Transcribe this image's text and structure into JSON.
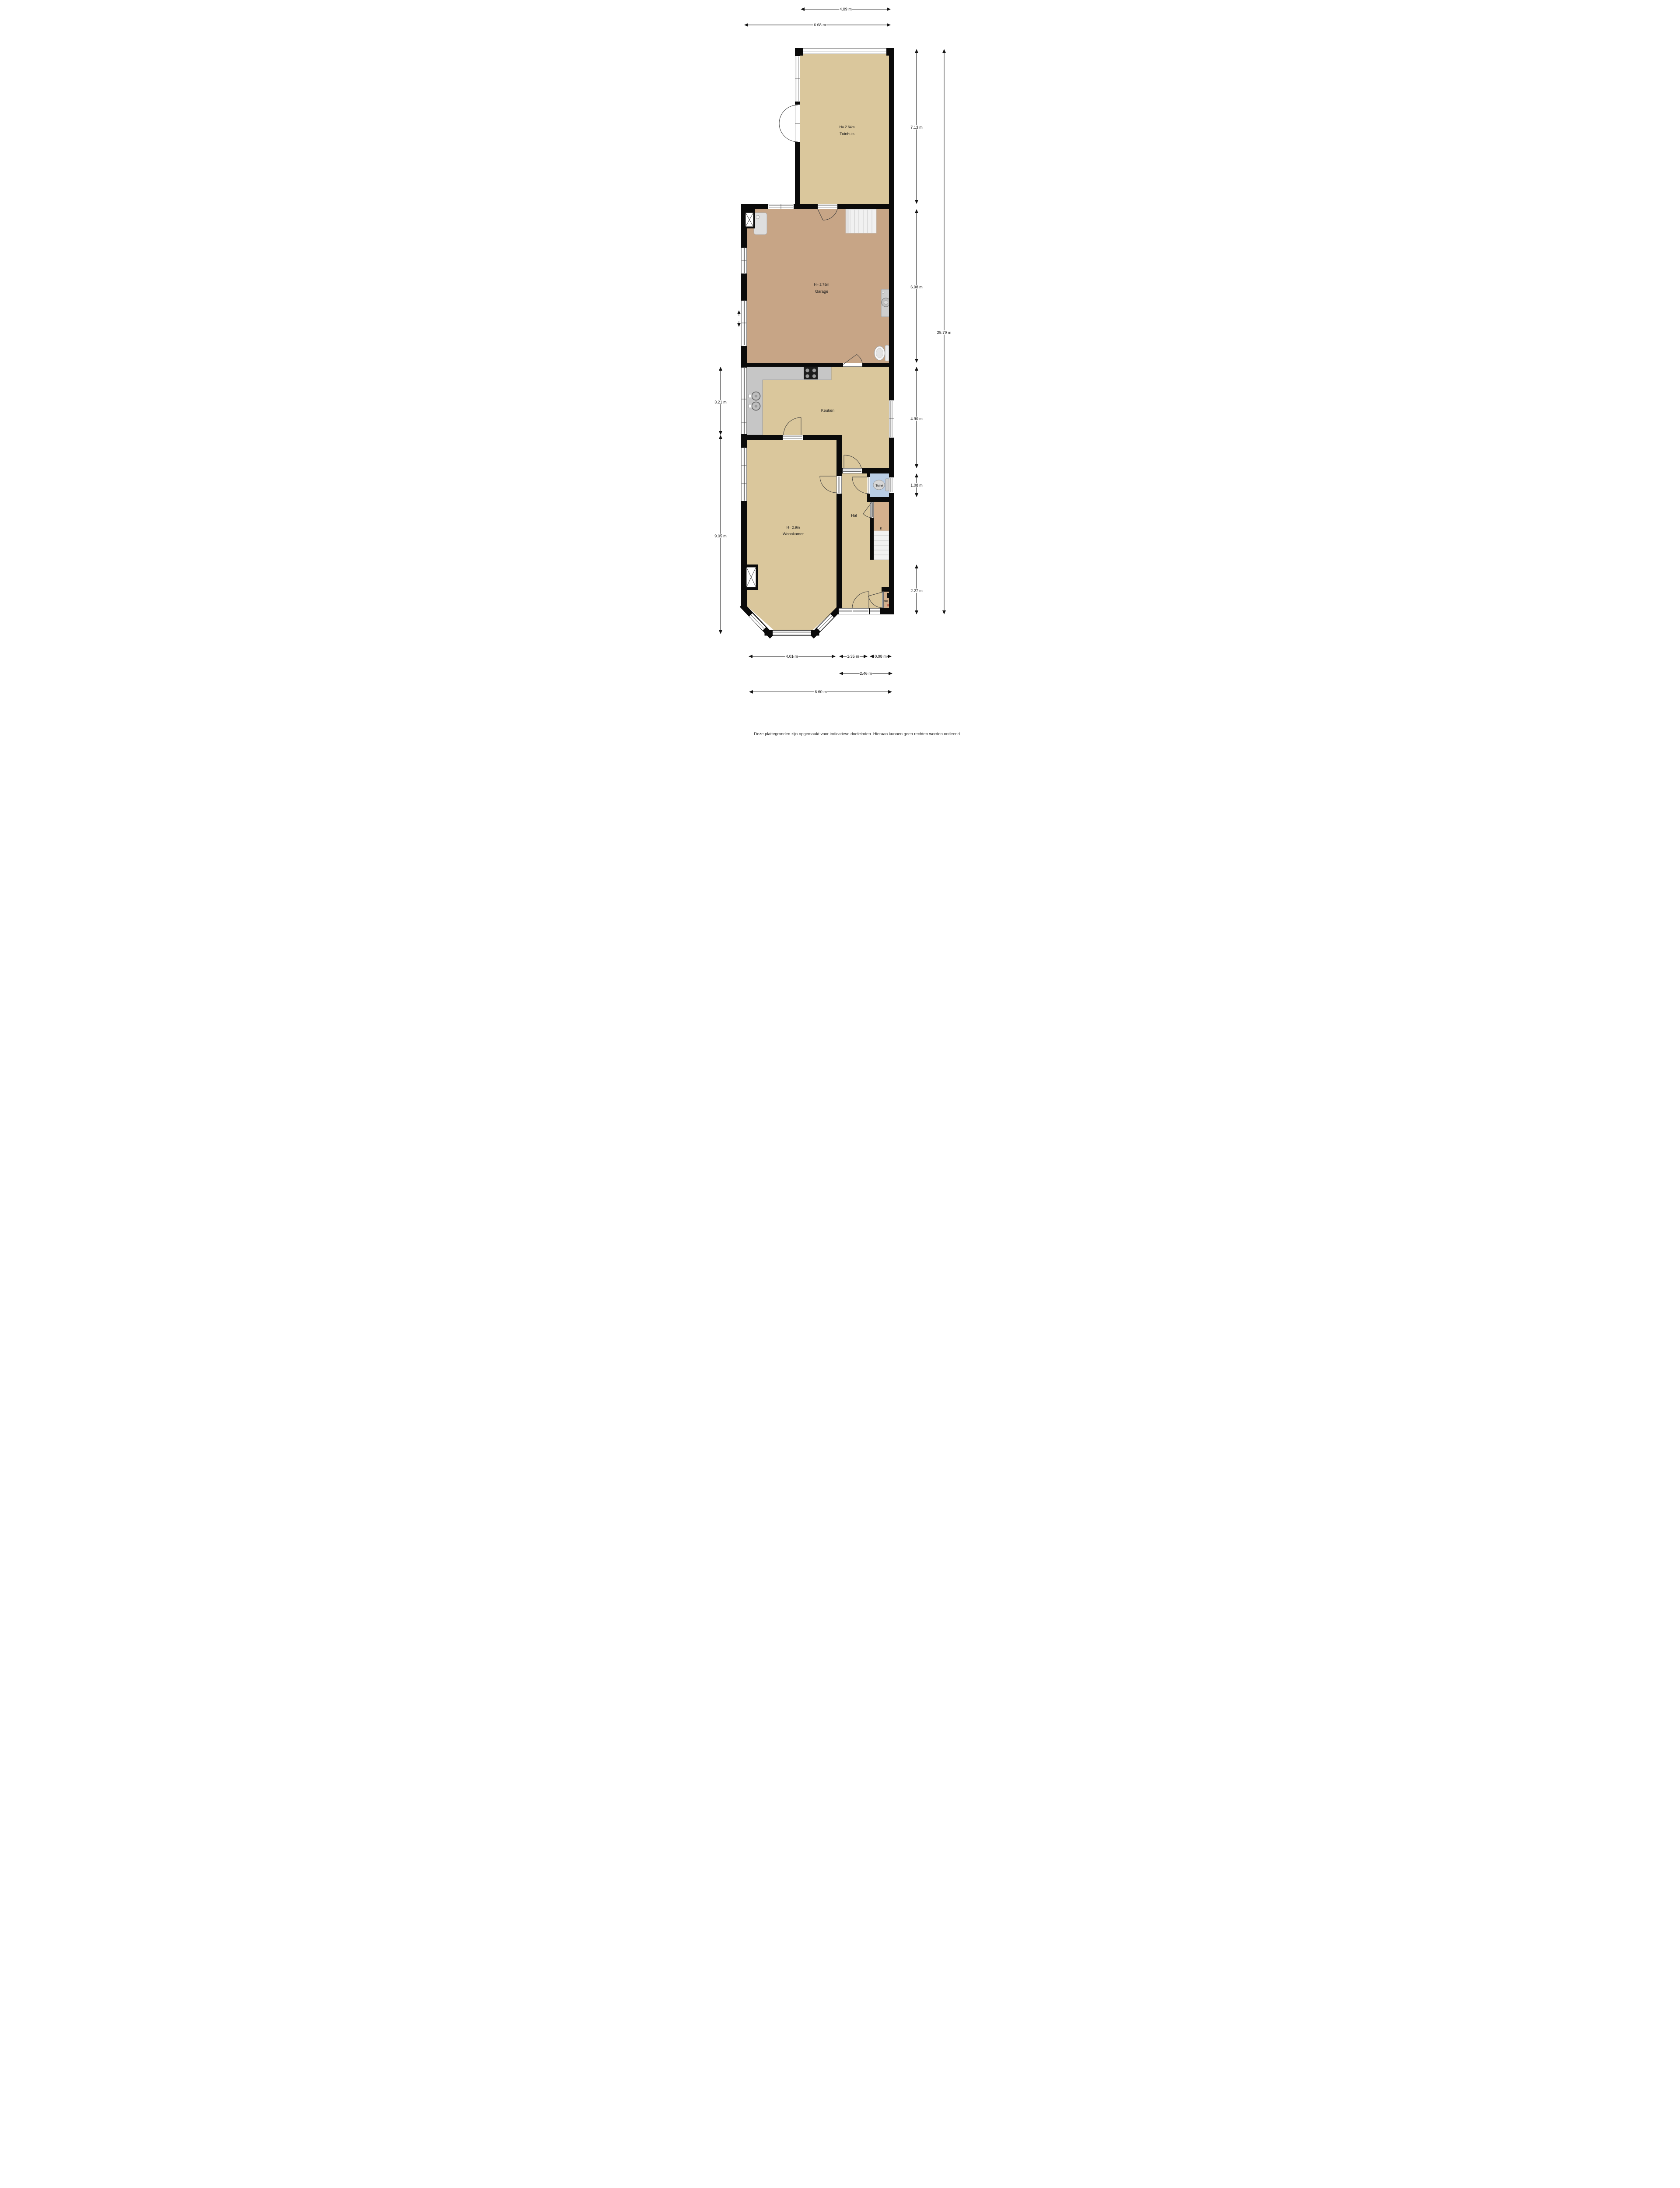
{
  "document": {
    "type": "floorplan",
    "footer": "Deze plattegronden zijn opgemaakt voor indicatieve doeleinden. Hieraan kunnen geen rechten worden ontleend."
  },
  "rooms": {
    "tuinhuis": {
      "name": "Tuinhuis",
      "height_label": "H= 2.64m"
    },
    "garage": {
      "name": "Garage",
      "height_label": "H= 2.75m"
    },
    "keuken": {
      "name": "Keuken"
    },
    "woonkamer": {
      "name": "Woonkamer",
      "height_label": "H= 2.9m"
    },
    "hal": {
      "name": "Hal"
    },
    "toilet": {
      "name": "Toilet"
    },
    "kast": {
      "name": "K"
    },
    "meterkast": {
      "name": "MK"
    }
  },
  "dims": {
    "top_tuinhuis": "4.09 m",
    "top_total": "6.68 m",
    "right_tuinhuis": "7.13 m",
    "right_garage": "6.98 m",
    "right_keuken": "4.90 m",
    "right_toilet": "1.08 m",
    "right_front": "2.27 m",
    "right_total": "25.79 m",
    "left_keuken": "3.21 m",
    "left_woonkamer": "9.05 m",
    "bottom_woonkamer": "4.01 m",
    "bottom_hal": "1.35 m",
    "bottom_closet": "0.98 m",
    "bottom_entry": "2.46 m",
    "bottom_total": "6.60 m"
  },
  "colors": {
    "wall": "#0a0a0a",
    "floor": "#dac79c",
    "garage_floor": "#c7a586",
    "closet_floor": "#d4b08d",
    "toilet_floor": "#b9cde5",
    "counter": "#c6c6c6",
    "stairs": "#f1f1f1",
    "dimension_line": "#141414"
  }
}
